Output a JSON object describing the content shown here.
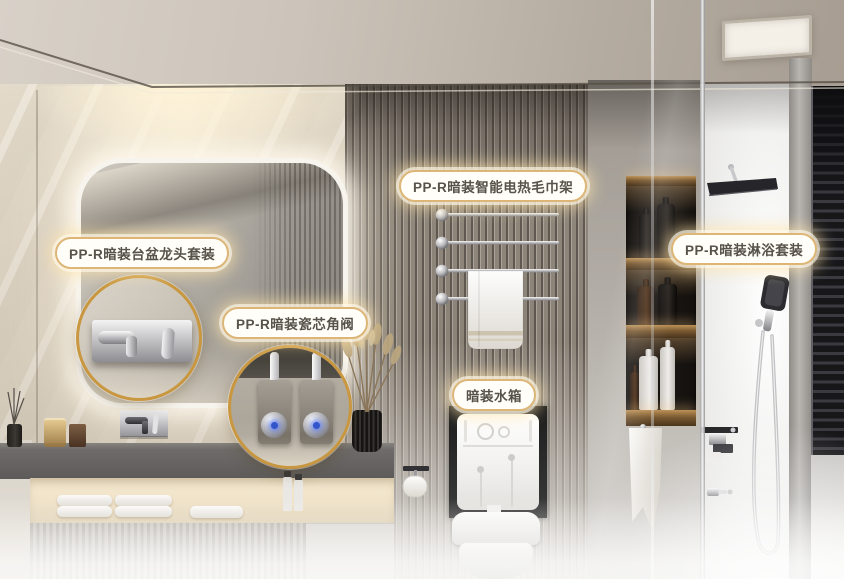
{
  "callouts": {
    "basin_faucet": {
      "label": "PP-R暗装台盆龙头套装"
    },
    "angle_valve": {
      "label": "PP-R暗装瓷芯角阀"
    },
    "towel_rack": {
      "label": "PP-R暗装智能电热毛巾架"
    },
    "cistern": {
      "label": "暗装水箱"
    },
    "shower": {
      "label": "PP-R暗装淋浴套装"
    }
  },
  "colors": {
    "label_border": "#dcb577",
    "label_text": "#57524a",
    "callout_ring": "#c9973f",
    "valve_led": "#3355cc"
  }
}
